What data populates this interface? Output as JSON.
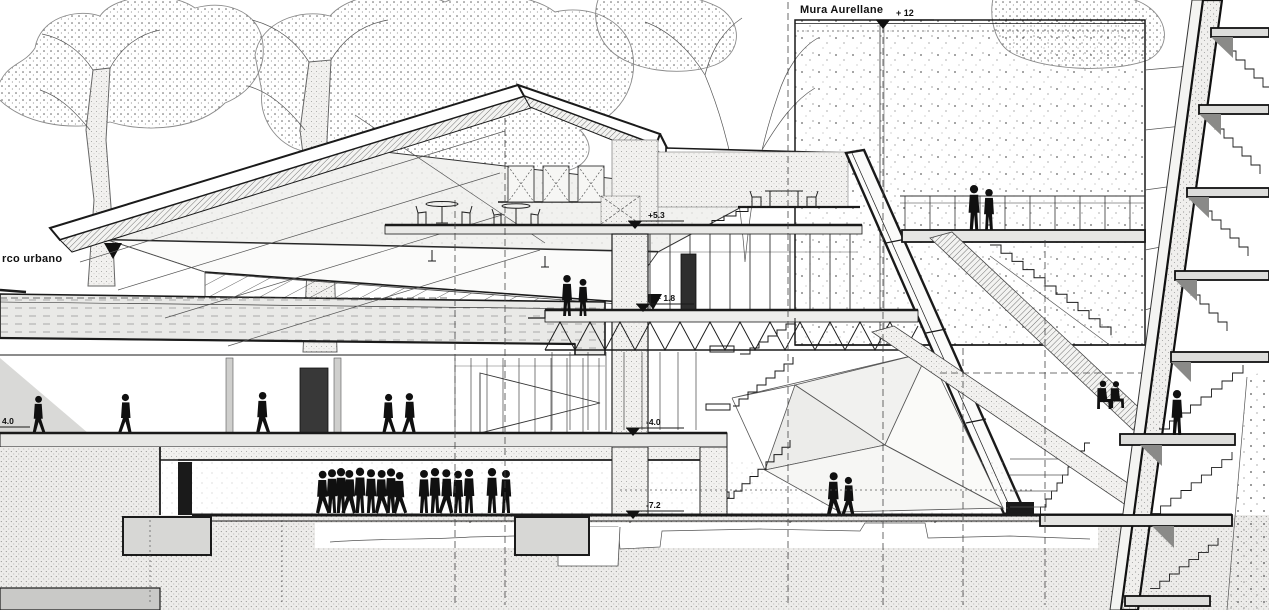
{
  "drawing": {
    "type": "architectural-section",
    "labels": {
      "wall_name": "Mura Aurellane",
      "park_name": "rco urbano"
    },
    "markers": [
      {
        "id": "wall-top",
        "text": "+ 12"
      },
      {
        "id": "upper-terrace",
        "text": "+5.3"
      },
      {
        "id": "mid-terrace",
        "text": "+ 1.8"
      },
      {
        "id": "lower-gallery",
        "text": "-4.0"
      },
      {
        "id": "basement",
        "text": "-7.2"
      },
      {
        "id": "left-edge",
        "text": "4.0"
      }
    ],
    "colors": {
      "ink": "#1a1a1a",
      "paper": "#ffffff",
      "slab_gray": "#e8e8e6",
      "foundation_gray": "#d7d7d5",
      "figure_black": "#101010"
    },
    "figures": {
      "gallery_walkers": 5,
      "main_crowd": 14,
      "crowd_pair": 2,
      "wall_terrace_pair": 2,
      "mid_terrace_pair": 2,
      "hall_couple": 2,
      "tower_seated": 2,
      "tower_standing": 1
    }
  }
}
